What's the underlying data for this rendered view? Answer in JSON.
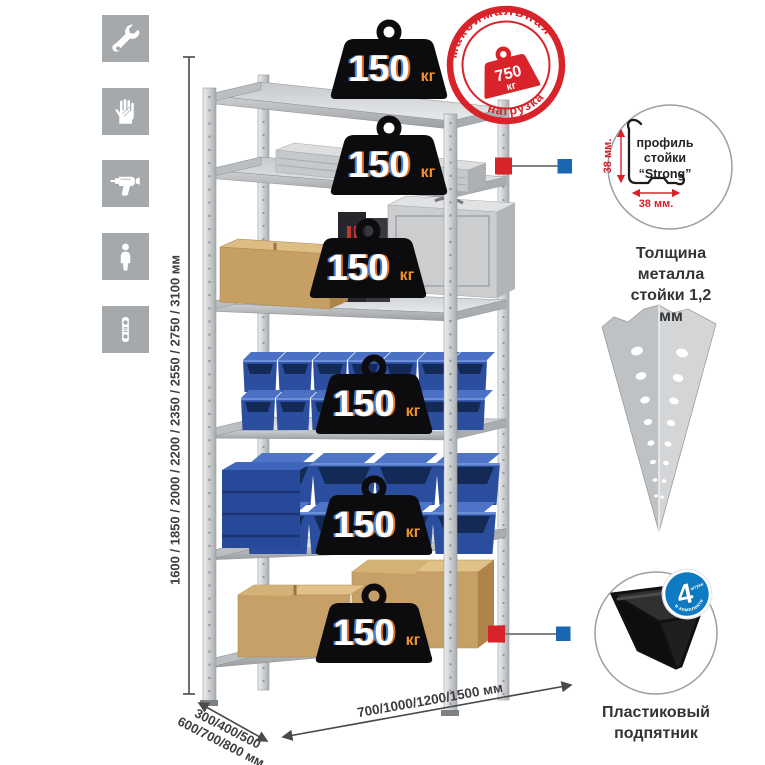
{
  "page": {
    "background": "#ffffff"
  },
  "sidebar": {
    "icons": [
      {
        "name": "wrench-icon"
      },
      {
        "name": "gloves-icon"
      },
      {
        "name": "drill-icon"
      },
      {
        "name": "assembly-person-icon"
      },
      {
        "name": "level-icon"
      }
    ]
  },
  "weight_badge": {
    "value": "150",
    "unit": "кг"
  },
  "stamp": {
    "arc_top": "максимальная",
    "arc_bottom": "нагрузка",
    "value": "750",
    "unit": "кг"
  },
  "dimensions": {
    "height": "1600 / 1850 / 2000 / 2200 / 2350 / 2550 / 2750 / 3100 мм",
    "depth_line1": "300/400/500",
    "depth_line2": "600/700/800 мм",
    "width": "700/1000/1200/1500 мм"
  },
  "profile_detail": {
    "label_line1": "профиль",
    "label_line2": "стойки",
    "label_line3": "“Strong”",
    "dim_vertical": "38 мм.",
    "dim_horizontal": "38 мм.",
    "caption_line1": "Толщина металла",
    "caption_line2": "стойки 1,2 мм"
  },
  "foot_detail": {
    "badge_number": "4",
    "badge_note": "штуки",
    "badge_arc": "в комплекте",
    "caption_line1": "Пластиковый",
    "caption_line2": "подпятник"
  },
  "colors": {
    "accent_red": "#d8232a",
    "accent_blue": "#1966b2",
    "bin_blue": "#2b4d9d",
    "tile_gray": "#a6a9ac",
    "metal_gray": "#d5d7d9"
  }
}
